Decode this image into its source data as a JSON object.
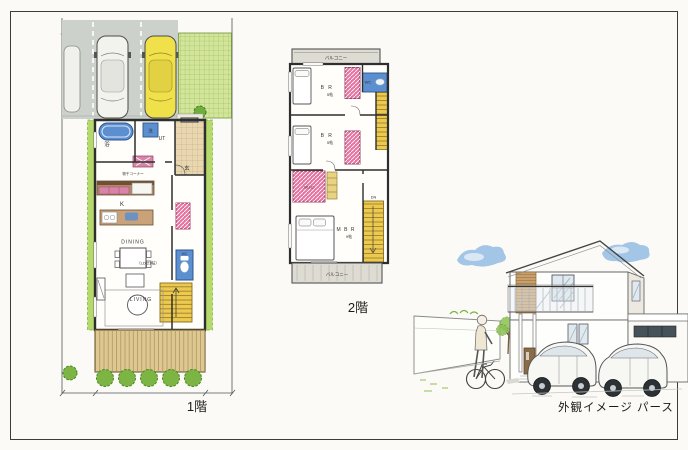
{
  "colors": {
    "paper": "#fbfaf6",
    "paving_gray": "#cdd1cc",
    "car_yellow": "#f0e049",
    "lawn_green": "#b5d96b",
    "grid_green": "#d3e59a",
    "deck_tan": "#dec892",
    "tile_tan": "#e8d7b0",
    "fixture_blue": "#5c8fd0",
    "closet_pink": "#e6739f",
    "stair_yellow": "#ecc94f",
    "balcony_gray": "#dedbd2",
    "shrub_green": "#7cb544",
    "cloud_blue": "#85b4e2"
  },
  "floor1": {
    "caption": "1階",
    "labels": {
      "bath": "浴",
      "laundry": "洗",
      "utility": "UT",
      "entrance": "玄",
      "drying_corner": "物干コーナー",
      "kitchen": "K",
      "dining": "DINING",
      "ld_size": "（LD 21帖）",
      "living": "LIVING",
      "wc": "WC"
    }
  },
  "floor2": {
    "caption": "2階",
    "labels": {
      "balcony_top": "バルコニー",
      "bedroom1": "B R",
      "bedroom1_size": "5帖",
      "bedroom2": "B R",
      "bedroom2_size": "5帖",
      "wc": "WC",
      "wic": "W.I.C",
      "down": "DN",
      "master": "M B R",
      "master_size": "9帖",
      "balcony_bottom": "バルコニー"
    }
  },
  "perspective": {
    "caption": "外観イメージ パース"
  }
}
